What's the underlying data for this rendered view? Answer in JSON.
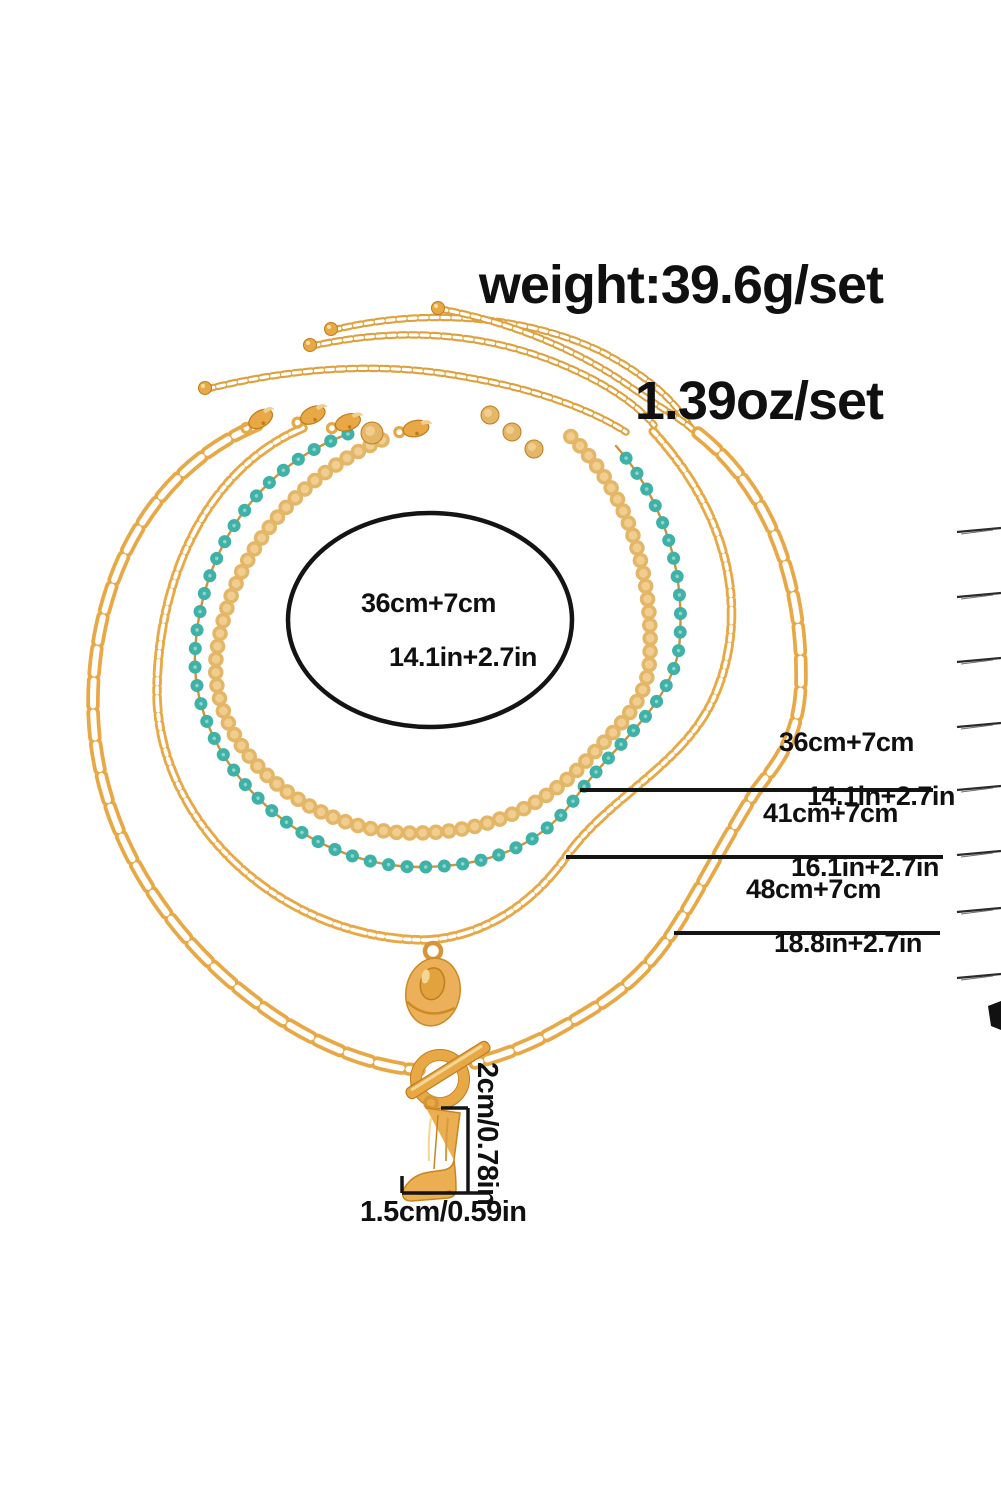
{
  "product": {
    "weight_line1": "weight:39.6g/set",
    "weight_line2": "1.39oz/set"
  },
  "labels": {
    "ellipse_label": {
      "line1": "36cm+7cm",
      "line2": "14.1in+2.7in"
    },
    "measure1": {
      "line1": "36cm+7cm",
      "line2": "14.1in+2.7in"
    },
    "measure2": {
      "line1": "41cm+7cm",
      "line2": "16.1in+2.7in"
    },
    "measure3": {
      "line1": "48cm+7cm",
      "line2": "18.8in+2.7in"
    },
    "pendant_height": "2cm/0.78in",
    "pendant_width": "1.5cm/0.59in"
  },
  "colors": {
    "gold": "#E7A845",
    "gold_dark": "#C07C1C",
    "gold_under": "#CE9338",
    "disc_gold": "#E4B667",
    "disc_light": "#F0CE8F",
    "teal": "#3FB1A7",
    "ink": "#141414",
    "scratch": "#2B2B2B",
    "white": "#FFFFFF"
  },
  "graphics": {
    "canvas": {
      "w": 1001,
      "h": 1500
    },
    "chains": [
      {
        "name": "extender-chain-1",
        "type": "cable",
        "path": "M 207,389 C 300,366 390,362 470,378 C 535,389 592,410 626,432"
      },
      {
        "name": "extender-chain-2",
        "type": "cable",
        "path": "M 312,346 C 392,328 472,332 542,357 C 592,375 632,399 654,425"
      },
      {
        "name": "extender-chain-3",
        "type": "cable",
        "path": "M 333,330 C 432,306 532,318 602,352 C 650,377 678,404 691,429"
      },
      {
        "name": "extender-chain-4",
        "type": "cable",
        "path": "M 440,309 C 512,322 582,352 632,388 C 668,413 691,424 699,437"
      },
      {
        "name": "disc-sequin-chain",
        "type": "discs",
        "path": "M 382,440 C 292,479 231,558 217,650 C 203,742 300,831 410,833 C 490,834 545,805 585,762 C 625,720 648,700 650,655 C 653,560 621,482 566,432"
      },
      {
        "name": "turquoise-bead-chain",
        "type": "beads",
        "path": "M 348,434 C 252,469 199,558 195,654 C 191,762 300,867 420,867 C 500,867 548,838 579,793 C 617,742 670,706 679,648 C 688,560 655,490 616,446"
      },
      {
        "name": "figaro-chain",
        "type": "figaro",
        "path": "M 303,428 C 206,469 158,579 157,690 C 156,822 281,940 427,940 C 490,936 537,898 566,857 C 610,795 685,765 715,695 C 745,625 740,525 651,429"
      },
      {
        "name": "paperclip-chain-left",
        "type": "paperclip",
        "path": "M 257,425 C 151,469 94,579 93,700 C 92,831 171,941 261,1006 C 321,1050 381,1068 419,1070"
      },
      {
        "name": "paperclip-chain-right",
        "type": "paperclip",
        "path": "M 698,433 C 770,490 802,580 801,680 C 800,740 775,765 755,792 C 722,845 700,890 672,933 C 640,980 610,1000 564,1026 C 530,1046 500,1056 475,1063"
      }
    ],
    "clasps": [
      {
        "x": 259,
        "y": 420,
        "rot": -32
      },
      {
        "x": 311,
        "y": 416,
        "rot": -26
      },
      {
        "x": 346,
        "y": 423,
        "rot": -20
      },
      {
        "x": 414,
        "y": 429,
        "rot": -12
      }
    ],
    "balls": [
      {
        "x": 205,
        "y": 388
      },
      {
        "x": 310,
        "y": 345
      },
      {
        "x": 331,
        "y": 329
      },
      {
        "x": 438,
        "y": 308
      }
    ],
    "cluster_discs": [
      {
        "x": 372,
        "y": 433,
        "r": 11
      },
      {
        "x": 490,
        "y": 415,
        "r": 9
      },
      {
        "x": 512,
        "y": 432,
        "r": 9
      },
      {
        "x": 534,
        "y": 449,
        "r": 9
      }
    ],
    "hat_pendant": {
      "ring": [
        433,
        951,
        8
      ],
      "cx": 433,
      "cy": 992,
      "rx": 27,
      "ry": 34,
      "rot": 10
    },
    "toggle": {
      "ring": [
        440,
        1079,
        24
      ],
      "bar": {
        "cx": 448,
        "cy": 1070,
        "len": 96,
        "w": 12,
        "rot": -32
      },
      "pin": [
        415,
        1090,
        6
      ]
    },
    "boot_pendant": {
      "tx": 398,
      "ty": 1106,
      "ring": [
        431,
        1103,
        6
      ],
      "body": "M 28,2 L 62,7 L 56,54 Q 55,62 46,64 L 32,66 Q 18,68 11,76 Q 3,84 5,90 Q 6,95 14,95 L 50,92 Q 58,91 58,83 Q 58,70 56,54",
      "stitch1": "M 40,9 L 36,63",
      "stitch2": "M 12,87 Q 32,90 53,85"
    },
    "annotation_ellipse": {
      "cx": 430,
      "cy": 620,
      "rx": 142,
      "ry": 107,
      "sw": 4.5
    },
    "measure_lines": [
      [
        580,
        790,
        933,
        790
      ],
      [
        566,
        857,
        943,
        857
      ],
      [
        674,
        933,
        940,
        933
      ]
    ],
    "bracket": {
      "vline": [
        468,
        1108,
        468,
        1193
      ],
      "top_tick": [
        441,
        1108,
        468,
        1108
      ],
      "left_tick": [
        402,
        1176,
        402,
        1193
      ],
      "hline": [
        402,
        1193,
        488,
        1193
      ]
    },
    "scratch_marks": {
      "x1": 957,
      "x2": 1001,
      "drop": 4,
      "ys": [
        529,
        594,
        659,
        724,
        787,
        852,
        909,
        975
      ]
    },
    "blob": "M 988,1006 L 1001,1001 L 1001,1030 L 991,1026 Z"
  }
}
